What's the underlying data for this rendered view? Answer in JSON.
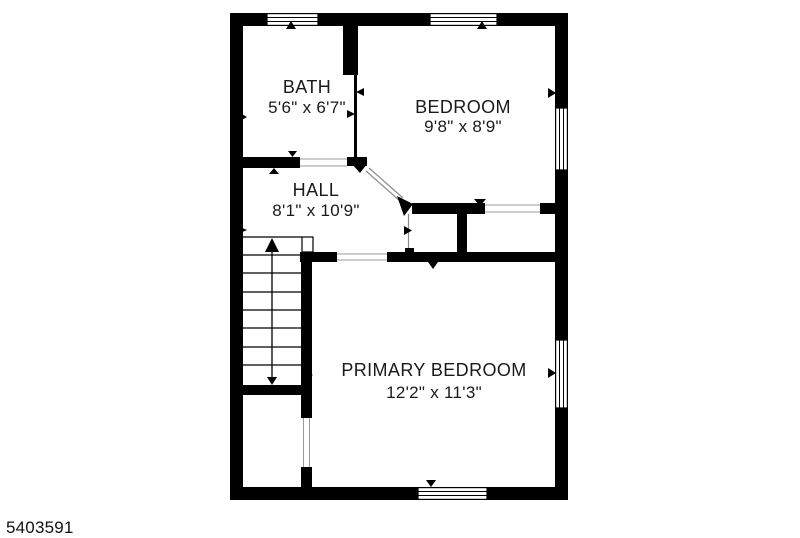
{
  "plan_id": "5403591",
  "colors": {
    "wall": "#000000",
    "floor": "#ffffff",
    "text": "#1a1a1a"
  },
  "rooms": [
    {
      "name": "BATH",
      "dimensions": "5'6\" x 6'7\""
    },
    {
      "name": "BEDROOM",
      "dimensions": "9'8\" x 8'9\""
    },
    {
      "name": "HALL",
      "dimensions": "8'1\" x 10'9\""
    },
    {
      "name": "PRIMARY BEDROOM",
      "dimensions": "12'2\" x 11'3\""
    }
  ]
}
